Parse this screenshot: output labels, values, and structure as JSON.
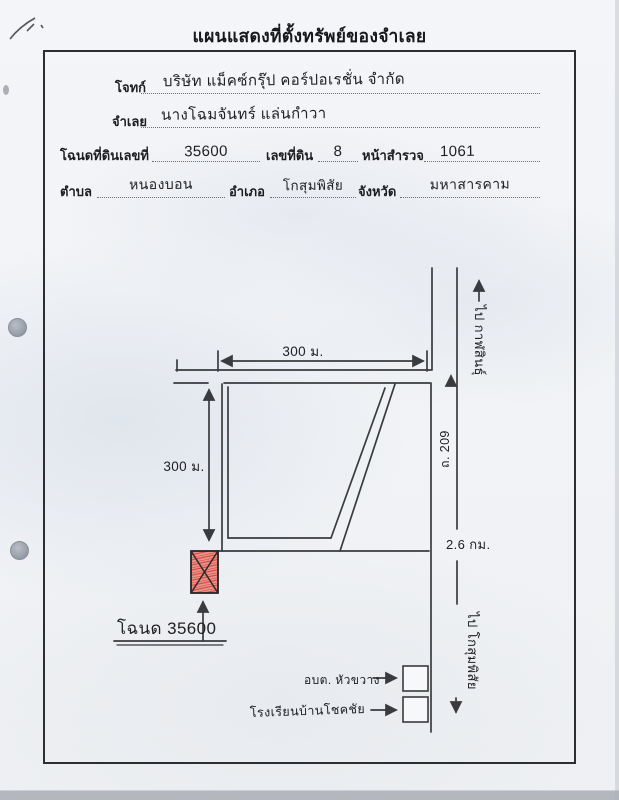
{
  "title": "แผนแสดงที่ตั้งทรัพย์ของจำเลย",
  "form": {
    "plaintiff_label": "โจทก์",
    "plaintiff_value": "บริษัท แม็คซ์กรุ๊ป คอร์ปอเรชั่น จำกัด",
    "defendant_label": "จำเลย",
    "defendant_value": "นางโฉมจันทร์ แล่นกำวา",
    "deed_no_label": "โฉนดที่ดินเลขที่",
    "deed_no_value": "35600",
    "parcel_no_label": "เลขที่ดิน",
    "parcel_no_value": "8",
    "survey_page_label": "หน้าสำรวจ",
    "survey_page_value": "1061",
    "subdistrict_label": "ตำบล",
    "subdistrict_value": "หนองบอน",
    "district_label": "อำเภอ",
    "district_value": "โกสุมพิสัย",
    "province_label": "จังหวัด",
    "province_value": "มหาสารคาม"
  },
  "map": {
    "dim_top": "300 ม.",
    "dim_left": "300 ม.",
    "road_label": "ถ. 209",
    "dist_label": "2.6 กม.",
    "dir_north": "ไป กาฬสินธุ์",
    "dir_south": "ไป โกสุมพิสัย",
    "deed_callout": "โฉนด 35600",
    "landmark1": "อบต. หัวขวาง",
    "landmark2": "โรงเรียนบ้านโชคชัย",
    "parcel_color": "#d6453a",
    "parcel_fill": "#e8938b",
    "ink_color": "#3a3b3e"
  }
}
